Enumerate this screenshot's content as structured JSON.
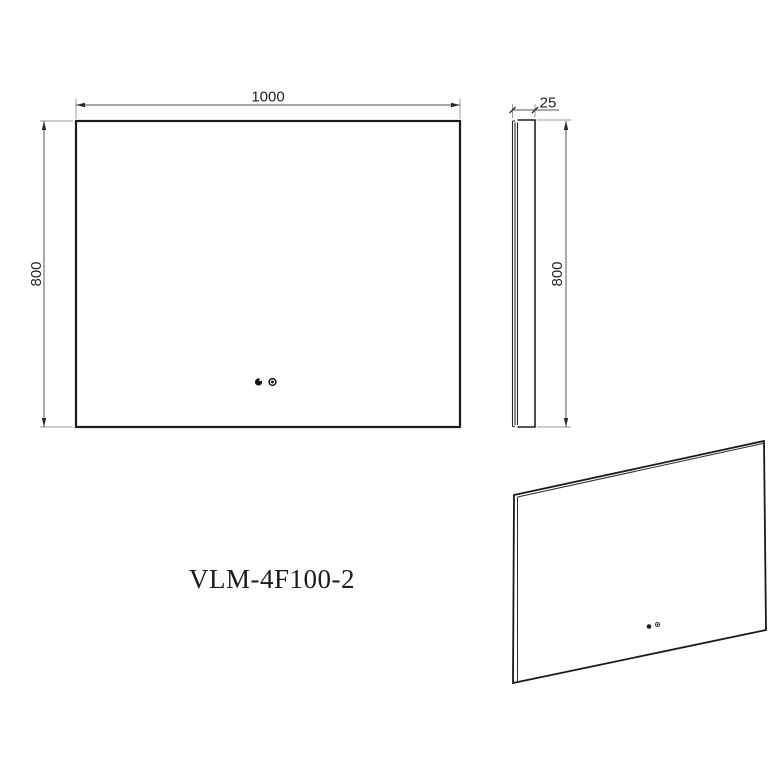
{
  "drawing": {
    "model_label": "VLM-4F100-2",
    "front_view": {
      "name": "front-view",
      "width_dim": "1000",
      "height_dim": "800"
    },
    "side_view": {
      "name": "side-view",
      "thickness_dim": "25",
      "height_dim": "800"
    },
    "perspective_view": {
      "name": "perspective-view"
    },
    "colors": {
      "background": "#ffffff",
      "outline": "#1a1a1a",
      "dim_line": "#555555",
      "extension_line": "#9a9a9a",
      "text": "#1f1f1f"
    }
  }
}
